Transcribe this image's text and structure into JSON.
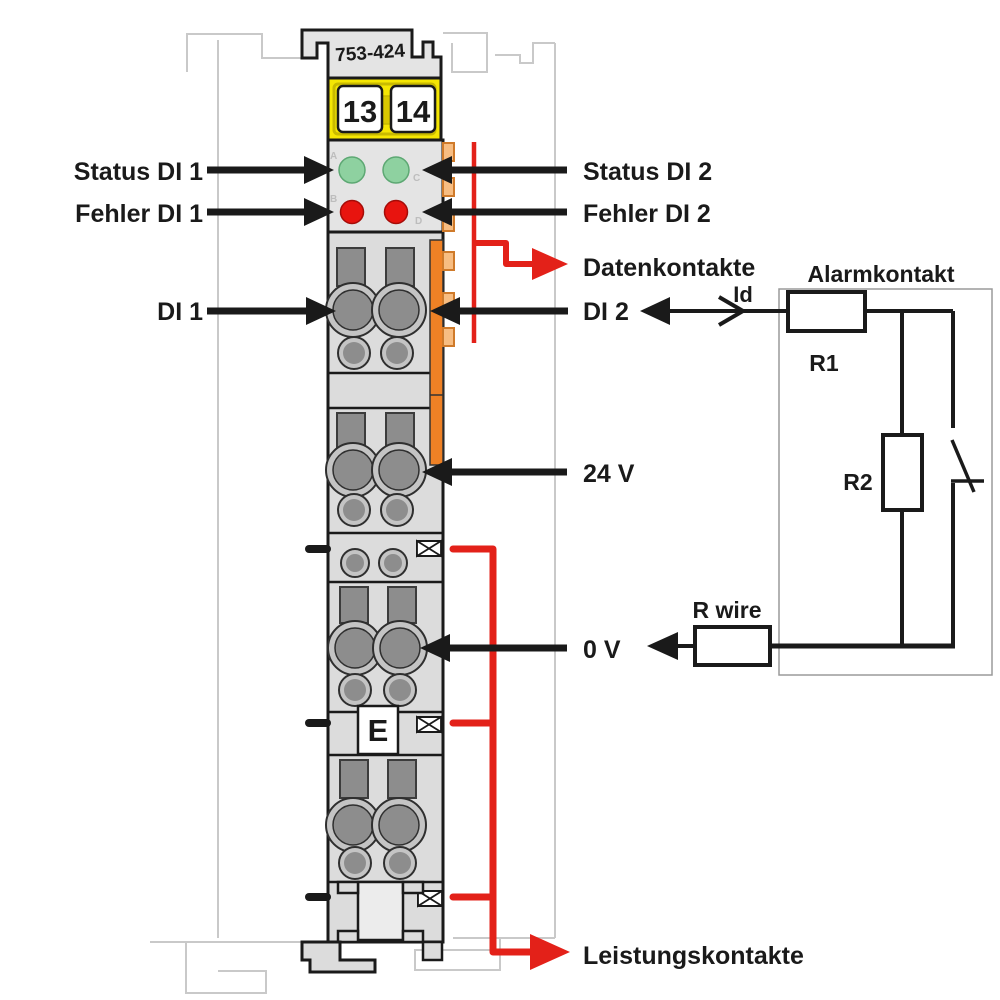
{
  "module": {
    "part_number": "753-424",
    "terminal_left": "13",
    "terminal_right": "14",
    "earth_marker": "E",
    "led_letters": {
      "a": "A",
      "b": "B",
      "c": "C",
      "d": "D"
    }
  },
  "labels": {
    "status_di1": "Status DI 1",
    "fehler_di1": "Fehler DI 1",
    "di1": "DI 1",
    "status_di2": "Status DI 2",
    "fehler_di2": "Fehler DI 2",
    "datenkontakte": "Datenkontakte",
    "di2": "DI 2",
    "v24": "24 V",
    "v0": "0 V",
    "leistungskontakte": "Leistungskontakte"
  },
  "circuit": {
    "title": "Alarmkontakt",
    "current": "Id",
    "r1": "R1",
    "r2": "R2",
    "r_wire": "R wire"
  },
  "colors": {
    "red": "#e32119",
    "led_green": "#8ed1a0",
    "led_green_edge": "#5da873",
    "led_red": "#e8140f",
    "led_red_edge": "#a50c08",
    "yellow": "#f5e603",
    "yellow_inner": "#c9ba00",
    "yellow_mid": "#d8c800",
    "orange": "#ef8125",
    "tab_orange": "#f7bd82",
    "tab_edge": "#cf7a2a",
    "module_gray": "#dcdcdc",
    "housing_gray": "#e4e4e4",
    "contact_gray": "#8d8d8d",
    "ring_gray": "#c4c4c4",
    "latch_gray": "#ececec",
    "rail_gray": "#c9c9c9",
    "box_gray": "#9a9a9a",
    "ink": "#1a1a1a"
  }
}
